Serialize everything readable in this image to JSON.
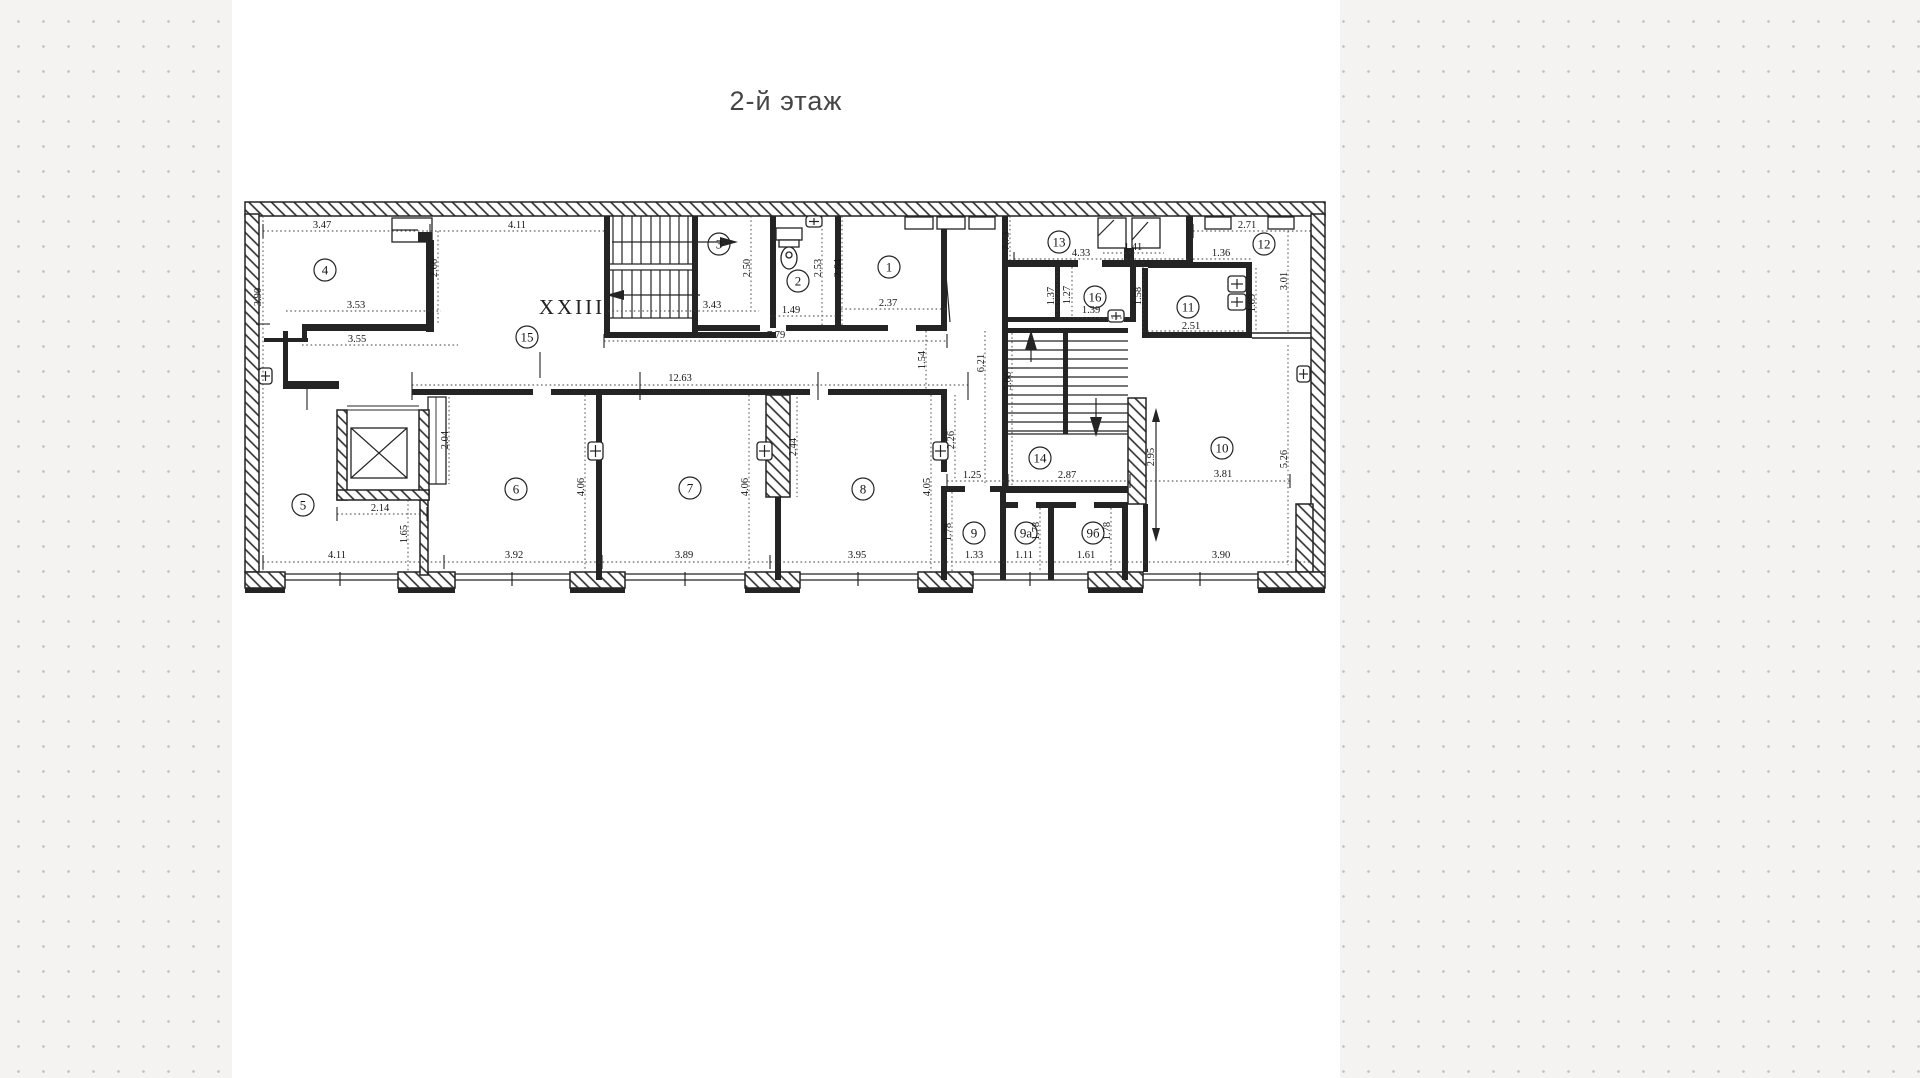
{
  "page": {
    "title": "2-й этаж",
    "colors": {
      "ink": "#242424",
      "paper": "#ffffff",
      "page_bg": "#f4f3f1",
      "dot": "#c7c5c2"
    }
  },
  "plan": {
    "labels": [
      {
        "t": "XXIII",
        "x": 572,
        "y": 314
      }
    ],
    "rooms": [
      {
        "n": "1",
        "x": 889,
        "y": 267
      },
      {
        "n": "2",
        "x": 798,
        "y": 281
      },
      {
        "n": "3",
        "x": 719,
        "y": 244
      },
      {
        "n": "4",
        "x": 325,
        "y": 270
      },
      {
        "n": "5",
        "x": 303,
        "y": 505
      },
      {
        "n": "6",
        "x": 516,
        "y": 489
      },
      {
        "n": "7",
        "x": 690,
        "y": 488
      },
      {
        "n": "8",
        "x": 863,
        "y": 489
      },
      {
        "n": "9",
        "x": 974,
        "y": 533
      },
      {
        "n": "9а",
        "x": 1026,
        "y": 533
      },
      {
        "n": "9б",
        "x": 1093,
        "y": 533
      },
      {
        "n": "10",
        "x": 1222,
        "y": 448
      },
      {
        "n": "11",
        "x": 1188,
        "y": 307
      },
      {
        "n": "12",
        "x": 1264,
        "y": 244
      },
      {
        "n": "13",
        "x": 1059,
        "y": 242
      },
      {
        "n": "14",
        "x": 1040,
        "y": 458
      },
      {
        "n": "15",
        "x": 527,
        "y": 337
      },
      {
        "n": "16",
        "x": 1095,
        "y": 297
      }
    ],
    "dims": [
      {
        "v": "3.47",
        "x": 322,
        "y": 228,
        "r": 0
      },
      {
        "v": "4.11",
        "x": 517,
        "y": 228,
        "r": 0
      },
      {
        "v": "3.90",
        "x": 261,
        "y": 297,
        "r": -90
      },
      {
        "v": "2.66",
        "x": 437,
        "y": 268,
        "r": -90
      },
      {
        "v": "3.53",
        "x": 356,
        "y": 308,
        "r": 0
      },
      {
        "v": "3.55",
        "x": 357,
        "y": 342,
        "r": 0
      },
      {
        "v": "2.50",
        "x": 750,
        "y": 268,
        "r": -90
      },
      {
        "v": "3.43",
        "x": 712,
        "y": 308,
        "r": 0
      },
      {
        "v": "1.49",
        "x": 791,
        "y": 313,
        "r": 0
      },
      {
        "v": "2.53",
        "x": 821,
        "y": 268,
        "r": -90
      },
      {
        "v": "2.64",
        "x": 841,
        "y": 268,
        "r": -90
      },
      {
        "v": "2.37",
        "x": 888,
        "y": 306,
        "r": 0
      },
      {
        "v": "7.79",
        "x": 776,
        "y": 338,
        "r": 0
      },
      {
        "v": "7.73",
        "x": 1009,
        "y": 241,
        "r": -90,
        "s": 8
      },
      {
        "v": "4.33",
        "x": 1081,
        "y": 256,
        "r": 0
      },
      {
        "v": "1.41",
        "x": 1133,
        "y": 250,
        "r": 0,
        "s": 9
      },
      {
        "v": "2.71",
        "x": 1247,
        "y": 228,
        "r": 0
      },
      {
        "v": "1.36",
        "x": 1221,
        "y": 256,
        "r": 0
      },
      {
        "v": "3.01",
        "x": 1287,
        "y": 281,
        "r": -90
      },
      {
        "v": "1.69",
        "x": 1255,
        "y": 303,
        "r": -90
      },
      {
        "v": "1.37",
        "x": 1054,
        "y": 296,
        "r": -90
      },
      {
        "v": "1.27",
        "x": 1070,
        "y": 295,
        "r": -90
      },
      {
        "v": "1.39",
        "x": 1091,
        "y": 313,
        "r": 0
      },
      {
        "v": "1.58",
        "x": 1141,
        "y": 296,
        "r": -90
      },
      {
        "v": "2.51",
        "x": 1191,
        "y": 329,
        "r": 0
      },
      {
        "v": "12.63",
        "x": 680,
        "y": 381,
        "r": 0
      },
      {
        "v": "1.54",
        "x": 925,
        "y": 360,
        "r": -90
      },
      {
        "v": "6.21",
        "x": 984,
        "y": 363,
        "r": -90
      },
      {
        "v": "5.06",
        "x": 1011,
        "y": 381,
        "r": -90
      },
      {
        "v": "2.04",
        "x": 448,
        "y": 440,
        "r": -90
      },
      {
        "v": "2.14",
        "x": 380,
        "y": 511,
        "r": 0
      },
      {
        "v": "1.65",
        "x": 407,
        "y": 534,
        "r": -90
      },
      {
        "v": "4.11",
        "x": 337,
        "y": 558,
        "r": 0
      },
      {
        "v": "3.92",
        "x": 514,
        "y": 558,
        "r": 0
      },
      {
        "v": "4.06",
        "x": 584,
        "y": 487,
        "r": -90
      },
      {
        "v": "2.44",
        "x": 796,
        "y": 447,
        "r": -90
      },
      {
        "v": "4.06",
        "x": 748,
        "y": 487,
        "r": -90
      },
      {
        "v": "3.89",
        "x": 684,
        "y": 558,
        "r": 0
      },
      {
        "v": "3.95",
        "x": 857,
        "y": 558,
        "r": 0
      },
      {
        "v": "4.05",
        "x": 930,
        "y": 487,
        "r": -90
      },
      {
        "v": "2.26",
        "x": 954,
        "y": 440,
        "r": -90
      },
      {
        "v": "1.25",
        "x": 972,
        "y": 478,
        "r": 0
      },
      {
        "v": "1.78",
        "x": 951,
        "y": 532,
        "r": -90
      },
      {
        "v": "1.33",
        "x": 974,
        "y": 558,
        "r": 0
      },
      {
        "v": "1.11",
        "x": 1024,
        "y": 558,
        "r": 0
      },
      {
        "v": "1.78",
        "x": 1039,
        "y": 531,
        "r": -90
      },
      {
        "v": "1.61",
        "x": 1086,
        "y": 558,
        "r": 0
      },
      {
        "v": "1.78",
        "x": 1110,
        "y": 531,
        "r": -90
      },
      {
        "v": "2.87",
        "x": 1067,
        "y": 478,
        "r": 0
      },
      {
        "v": "2.95",
        "x": 1154,
        "y": 457,
        "r": -90
      },
      {
        "v": "3.81",
        "x": 1223,
        "y": 477,
        "r": 0
      },
      {
        "v": "5.26",
        "x": 1287,
        "y": 459,
        "r": -90
      },
      {
        "v": "3.90",
        "x": 1221,
        "y": 558,
        "r": 0
      }
    ]
  }
}
